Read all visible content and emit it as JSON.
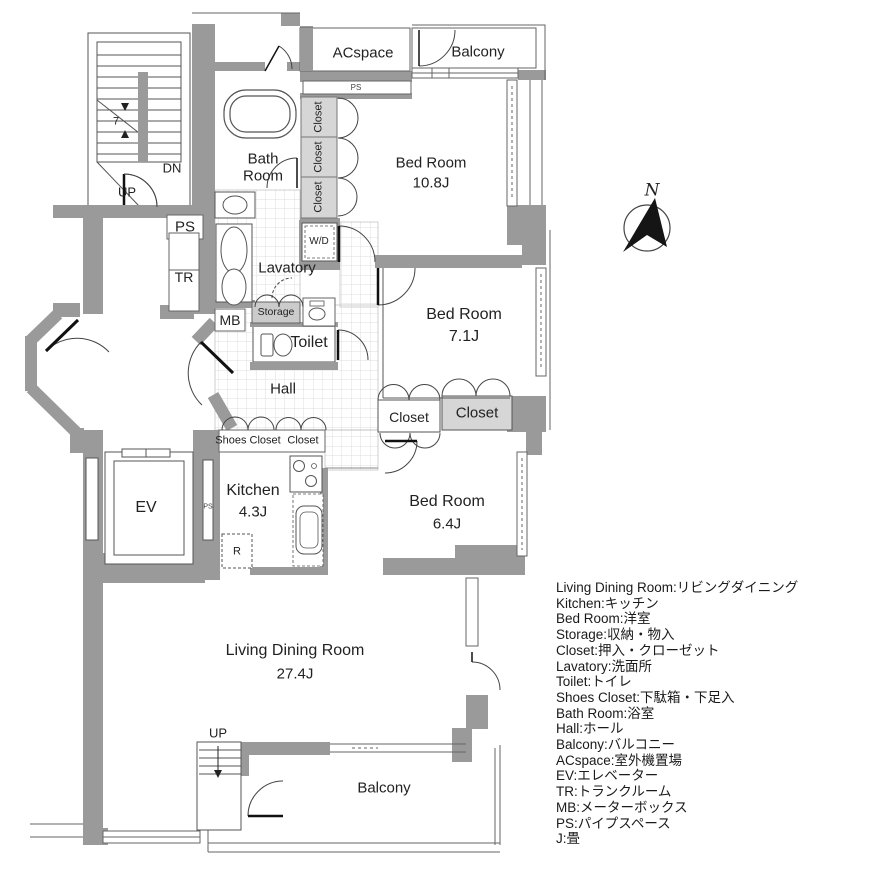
{
  "plan": {
    "labels": {
      "acspace": "ACspace",
      "balcony": "Balcony",
      "ps": "PS",
      "closet": "Closet",
      "bedroom1_name": "Bed Room",
      "bedroom1_size": "10.8J",
      "bath_line1": "Bath",
      "bath_line2": "Room",
      "dn": "DN",
      "up": "UP",
      "stair_count": "7",
      "tr": "TR",
      "wd": "W/D",
      "lavatory": "Lavatory",
      "storage": "Storage",
      "mb": "MB",
      "toilet": "Toilet",
      "hall": "Hall",
      "bedroom2_name": "Bed Room",
      "bedroom2_size": "7.1J",
      "shoes_closet": "Shoes Closet",
      "ev": "EV",
      "kitchen_name": "Kitchen",
      "kitchen_size": "4.3J",
      "refrigerator": "R",
      "bedroom3_name": "Bed Room",
      "bedroom3_size": "6.4J",
      "living_name": "Living Dining Room",
      "living_size": "27.4J"
    },
    "compass": {
      "north": "N"
    }
  },
  "legend": {
    "items": [
      "Living Dining Room:リビングダイニング",
      "Kitchen:キッチン",
      "Bed Room:洋室",
      "Storage:収納・物入",
      "Closet:押入・クローゼット",
      "Lavatory:洗面所",
      "Toilet:トイレ",
      "Shoes Closet:下駄箱・下足入",
      "Bath Room:浴室",
      "Hall:ホール",
      "Balcony:バルコニー",
      "ACspace:室外機置場",
      "EV:エレベーター",
      "TR:トランクルーム",
      "MB:メーターボックス",
      "PS:パイプスペース",
      "J:畳"
    ]
  },
  "colors": {
    "wall": "#9a9a9a",
    "closet_fill": "#d6d6d6",
    "line": "#555555"
  }
}
